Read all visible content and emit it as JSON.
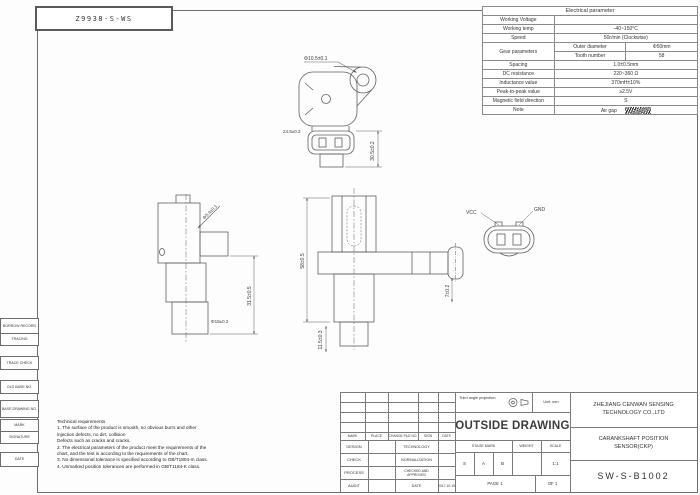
{
  "sheet": {
    "part_no": "Z9938-S-WS"
  },
  "electrical_table": {
    "title": "Electrical parameter",
    "rows": [
      {
        "label": "Working Voltage",
        "value": ""
      },
      {
        "label": "Working temp",
        "value": "-40~150°C"
      },
      {
        "label": "Speed",
        "value": "50r/min (Clockwise)"
      },
      {
        "label": "Spacing",
        "value": "1.0±0.5mm"
      },
      {
        "label": "DC resistance",
        "value": "220~360 Ω"
      },
      {
        "label": "Inductance value",
        "value": "370mH±10%"
      },
      {
        "label": "Peak-to-peak value",
        "value": "≥2.5V"
      },
      {
        "label": "Magnetic field direction",
        "value": "S"
      },
      {
        "label": "Note",
        "value": "Air gap"
      }
    ],
    "gear": {
      "label": "Gear parameters",
      "rows": [
        {
          "name": "Outer diameter",
          "value": "Φ50mm"
        },
        {
          "name": "Tooth number",
          "value": "58"
        }
      ]
    }
  },
  "views": {
    "top_view": {
      "hole_dim": "Φ10.5±0.1",
      "width_dim": "24.5±0.2",
      "height_dim": "30.5±0.2"
    },
    "side_view": {
      "pin_dim": "Φ5.4±0.1",
      "length_dim": "31.5±0.5",
      "tip_dim": "Φ18±0.2"
    },
    "front_view": {
      "height_dim": "58±0.5",
      "lower_dim": "11.5±0.3",
      "flange_dim": "7±0.2"
    },
    "connector": {
      "pin_left": "VCC",
      "pin_right": "GND"
    }
  },
  "tech_req": {
    "lines": [
      "Technical requirements",
      "1. The surface of the product is smooth, no obvious burrs and other",
      "injection defects, no dirt, collision",
      "Defects such as cracks and cracks.",
      "2. The electrical parameters of the product meet the requirements of the",
      "chart, and the test is according to the requirements of the chart.",
      "3. No dimensional tolerance is specified according to GB/T1804-m class.",
      "4. Unmarked position tolerances are performed in GB/T1184-K class."
    ]
  },
  "title_block": {
    "rev_headers": [
      "MARK",
      "PLACE",
      "CHANGE FILE NO.",
      "SIGN",
      "DATE"
    ],
    "sign_rows": [
      {
        "left": "DESIGN",
        "right": "TECHNOLOGY",
        "value": ""
      },
      {
        "left": "CHECK",
        "right": "NORMALIZATION",
        "value": ""
      },
      {
        "left": "PROCESS",
        "right": "CHECKED AND APPROVED",
        "value": ""
      },
      {
        "left": "AUDIT",
        "right": "DATE",
        "value": "2017.10.15"
      }
    ],
    "projection_note": "Third angle projection",
    "unit_note": "Unit: mm",
    "drawing_title": "OUTSIDE DRAWING",
    "stage_mark_label": "STAGE MARK",
    "weight_label": "WEIGHT",
    "scale_label": "SCALE",
    "stage_marks": [
      "S",
      "A",
      "B"
    ],
    "weight_value": "",
    "scale_value": "1:1",
    "page_left": "PAGE 1",
    "page_right": "OF 1",
    "company_line1": "ZHEJIANG CENWAN SENSING",
    "company_line2": "TECHNOLOGY CO.,LTD",
    "product_line1": "CARANKSHAFT POSITION",
    "product_line2": "SENSOR(CKP)",
    "drawing_no": "SW-S-B1002"
  },
  "margin_blocks": [
    "BORROW RECORD",
    "TRACING",
    "TRACE CHECK",
    "OLD BASE NO.",
    "BASE DRAWING NO.",
    "MARK",
    "SIGNATURE",
    "DATE"
  ]
}
